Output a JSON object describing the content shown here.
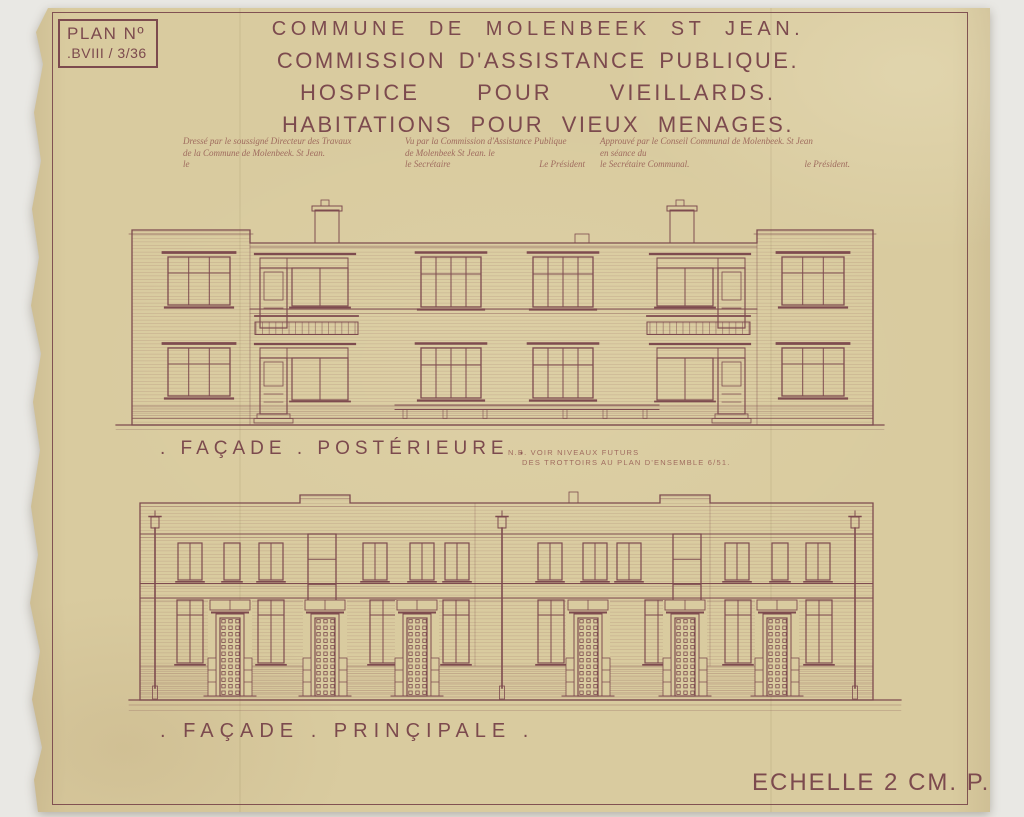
{
  "document": {
    "plan_box": {
      "line1": "PLAN Nº",
      "line2": ".BVIII / 3/36"
    },
    "title": {
      "line1": "COMMUNE DE MOLENBEEK ST JEAN.",
      "line2": "COMMISSION D'ASSISTANCE PUBLIQUE.",
      "line3": "HOSPICE POUR VIEILLARDS.",
      "line4": "HABITATIONS POUR VIEUX MENAGES."
    },
    "signatures": {
      "col1": {
        "line1": "Dressé par le soussigné Directeur des Travaux",
        "line2": "de la Commune de Molenbeek. St Jean.",
        "line3": "le"
      },
      "col2": {
        "line1": "Vu par la Commission d'Assistance Publique",
        "line2": "de Molenbeek St Jean. le",
        "left": "le Secrétaire",
        "right": "Le Président"
      },
      "col3": {
        "line1": "Approuvé par le Conseil Communal de Molenbeek. St Jean",
        "line2": "en séance du",
        "left": "le Secrétaire Communal.",
        "right": "le Président."
      }
    },
    "note": {
      "line1": "N.B.  VOIR NIVEAUX FUTURS",
      "line2": "DES TROTTOIRS AU PLAN D'ENSEMBLE 6/51."
    },
    "drawings": {
      "facade_posterieure_label": ". FAÇADE . POSTÉRIEURE .",
      "facade_principale_label": ". FAÇADE . PRINÇIPALE ."
    },
    "scale_label": "ECHELLE 2 CM. P.M."
  },
  "colors": {
    "paper": "#d9cb9f",
    "ink": "#7c4a4e",
    "ink_light": "#a06c5f",
    "background": "#e9e8e4"
  }
}
